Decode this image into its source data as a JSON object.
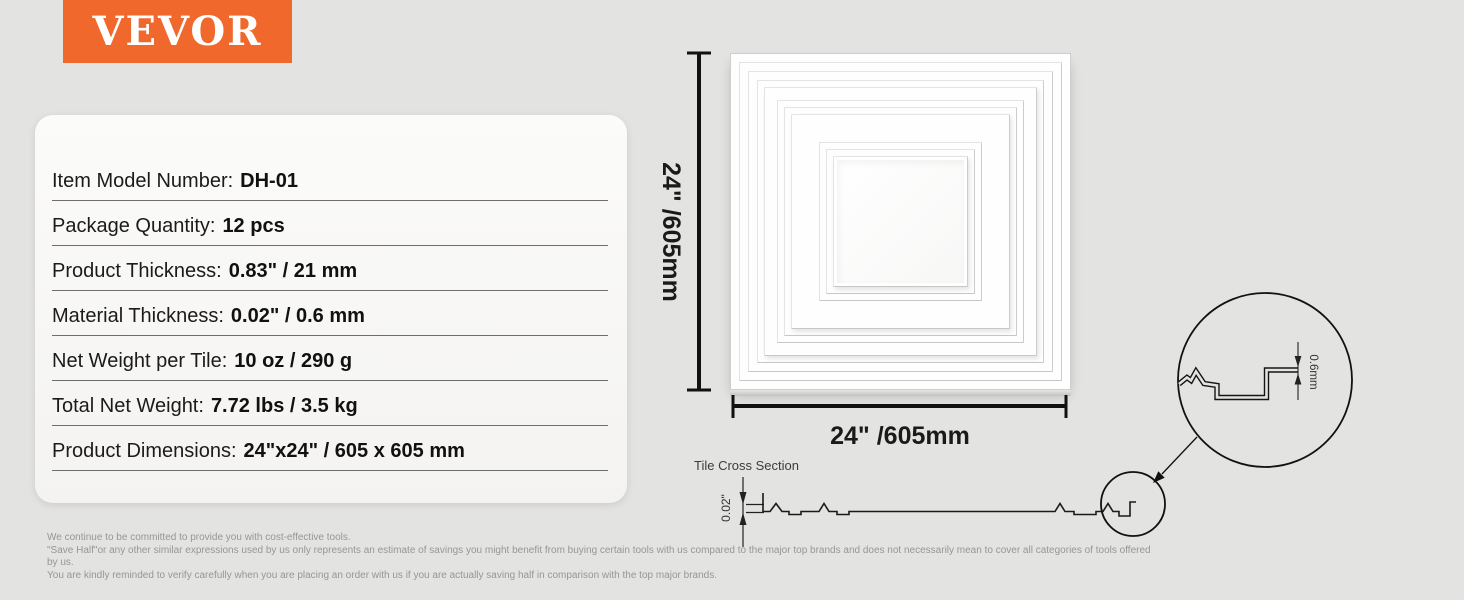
{
  "brand": {
    "logo_text": "VEVOR",
    "brand_color": "#f0682b"
  },
  "specs": {
    "rows": [
      {
        "label": "Item Model Number:",
        "value": "DH-01"
      },
      {
        "label": "Package Quantity:",
        "value": "12 pcs"
      },
      {
        "label": "Product Thickness:",
        "value": "0.83\" / 21 mm"
      },
      {
        "label": "Material Thickness:",
        "value": "0.02\" / 0.6 mm"
      },
      {
        "label": "Net Weight per Tile:",
        "value": "10 oz / 290 g"
      },
      {
        "label": "Total Net Weight:",
        "value": "7.72 lbs / 3.5 kg"
      },
      {
        "label": "Product Dimensions:",
        "value": "24\"x24\" / 605 x 605 mm"
      }
    ]
  },
  "diagram": {
    "height_label": "24\" /605mm",
    "width_label": "24\" /605mm",
    "cross_section_title": "Tile Cross Section",
    "cross_section_thickness_label": "0.02\"",
    "detail_thickness_label": "0.6mm"
  },
  "footer": {
    "lines": [
      "We continue to be committed to provide you with cost-effective tools.",
      "\"Save Half\"or any other similar expressions used by us only represents an estimate of savings you might benefit from buying certain tools with us compared to the major top brands and does not necessarily mean to cover all categories of tools offered by us.",
      "You are kindly reminded to verify carefully when you are placing an order with us if you are actually saving half in comparison with the top major brands."
    ]
  }
}
